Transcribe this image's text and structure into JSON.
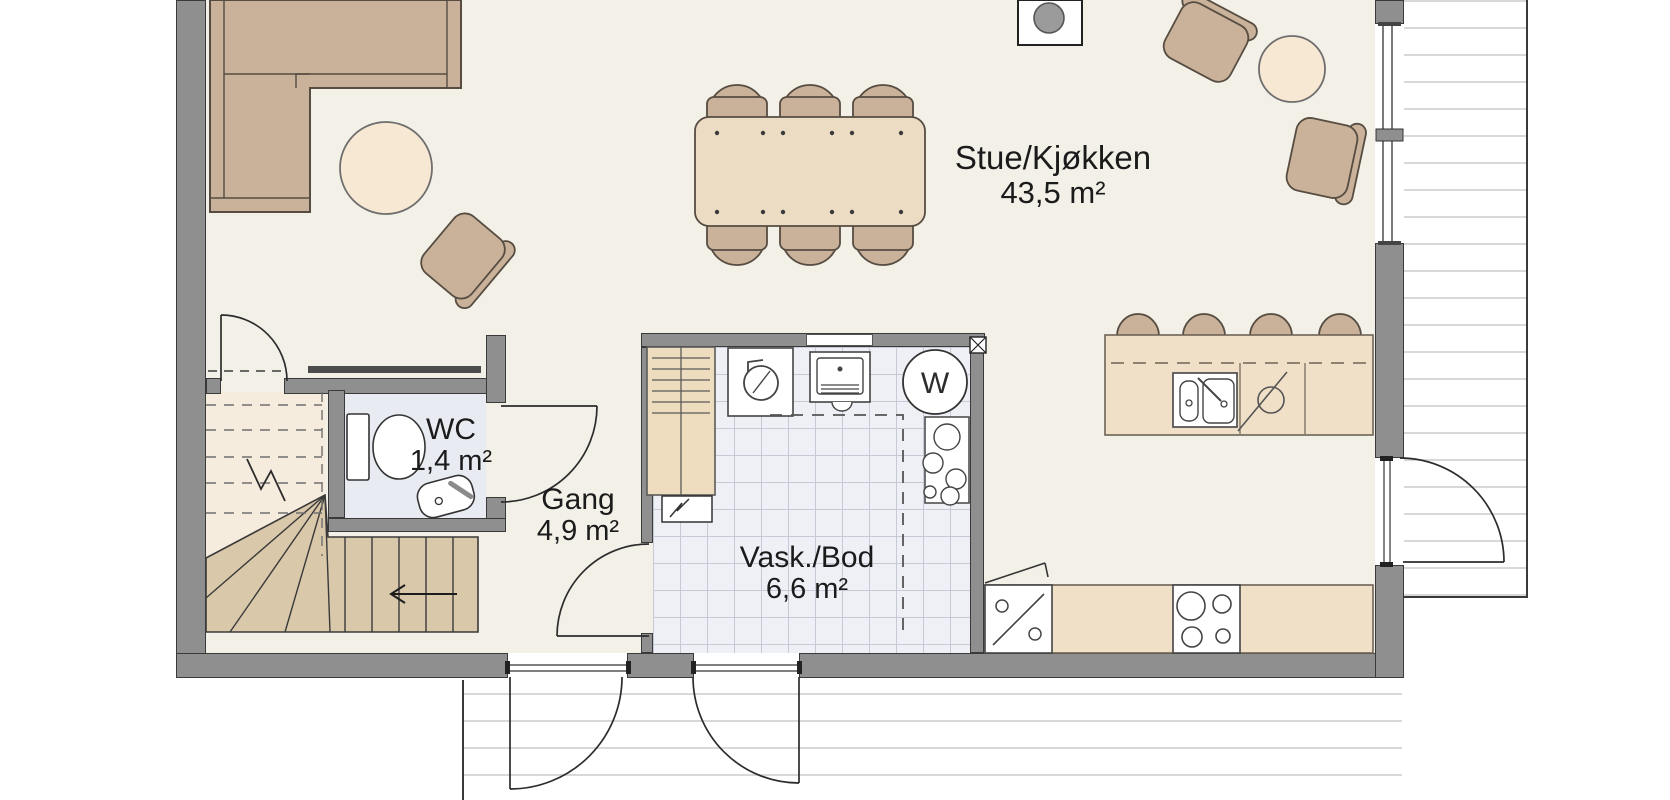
{
  "plan": {
    "rooms": [
      {
        "id": "stue-kjokken",
        "label": "Stue/Kjøkken",
        "area": "43,5 m²"
      },
      {
        "id": "wc",
        "label": "WC",
        "area": "1,4 m²"
      },
      {
        "id": "gang",
        "label": "Gang",
        "area": "4,9 m²"
      },
      {
        "id": "vask-bod",
        "label": "Vask./Bod",
        "area": "6,6 m²"
      }
    ],
    "appliances": {
      "washer_label": "W"
    },
    "fixtures": [
      "corner-sofa",
      "coffee-table",
      "armchair",
      "dining-table",
      "dining-chair",
      "fireplace-stove",
      "kitchen-island",
      "bar-stool",
      "kitchen-sink",
      "dishwasher",
      "cooktop",
      "wardrobe",
      "water-heater",
      "laundry-sink",
      "washing-machine",
      "pipe-manifold",
      "vent-box",
      "electrical-panel",
      "toilet",
      "wc-sink",
      "staircase",
      "stair-direction-arrow",
      "door-swing",
      "window",
      "deck-boards"
    ],
    "colors": {
      "wall": "#8f8f8f",
      "floor": "#f3f0e8",
      "wc_floor": "#e9ebf2",
      "tile_floor": "#eef0f6",
      "furniture_tan": "#c9b299",
      "table_light": "#f6e8d3",
      "counter": "#f1e0c8",
      "stair_upper": "#f6ecdd",
      "stair_lower": "#dac8aa",
      "outline": "#3a3a3a",
      "text": "#1b1b1b"
    }
  }
}
